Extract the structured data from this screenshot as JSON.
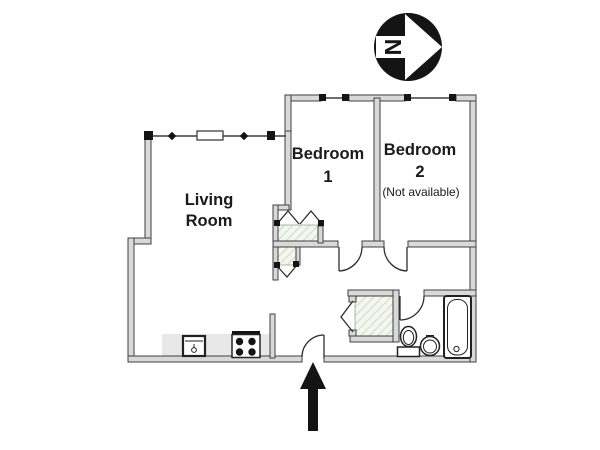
{
  "rooms": {
    "living_room": {
      "line1": "Living",
      "line2": "Room"
    },
    "bedroom_1": {
      "line1": "Bedroom",
      "line2": "1"
    },
    "bedroom_2": {
      "line1": "Bedroom",
      "line2": "2",
      "note": "(Not available)"
    }
  },
  "compass": {
    "north_label": "N"
  },
  "icons": {
    "compass": "north-arrow-icon",
    "entrance": "entrance-arrow-icon",
    "kitchen": [
      "kitchen-sink-icon",
      "stove-icon"
    ],
    "bathroom": [
      "toilet-icon",
      "bathroom-sink-icon",
      "bathtub-icon"
    ],
    "closets": [
      "bifold-door-icon",
      "chevron-door-icon"
    ]
  },
  "colors": {
    "wall_fill": "#d9d9d9",
    "wall_stroke": "#3f3f3f",
    "door_stroke": "#2f2f2f",
    "hatch_bg": "#f3f7ef",
    "hatch_stripe": "#c3d4ba",
    "counter": "#e8e8e8",
    "ink": "#1a1a1a",
    "black": "#141414"
  }
}
